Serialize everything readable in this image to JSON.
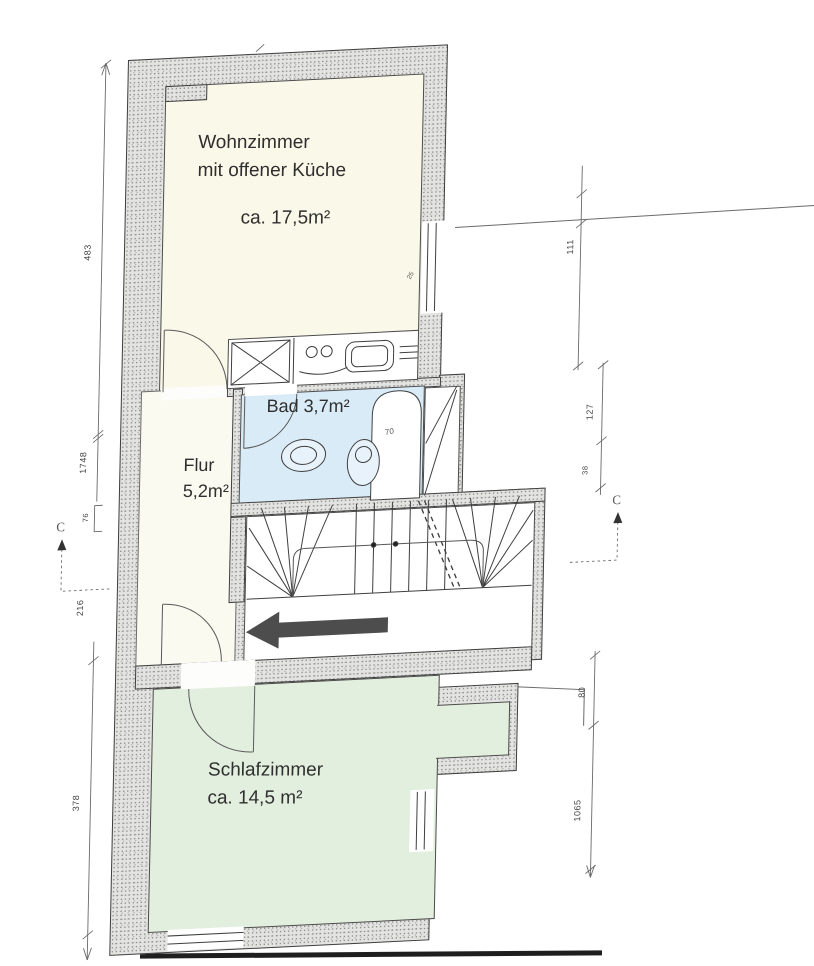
{
  "rooms": {
    "wohnzimmer": {
      "line1": "Wohnzimmer",
      "line2": "mit offener Küche",
      "area": "ca. 17,5m²"
    },
    "bad": {
      "label": "Bad 3,7m²"
    },
    "flur": {
      "name": "Flur",
      "area": "5,2m²"
    },
    "schlafzimmer": {
      "name": "Schlafzimmer",
      "area": "ca. 14,5 m²"
    }
  },
  "dimensions": {
    "left_top": "483",
    "left_mid": "1748",
    "left_small": "76",
    "left_center": "216",
    "left_bottom": "378",
    "right_top": "111",
    "right_mid": "127",
    "right_small": "38",
    "right_lower": "80",
    "right_bottom": "1065",
    "bathtub": "70",
    "window": "25"
  },
  "section_markers": {
    "left": "C",
    "right": "C"
  },
  "colors": {
    "wohnzimmer": "#faf8e8",
    "bad": "#d9ebf7",
    "schlafzimmer": "#e3efde",
    "flur": "#fbfaf1",
    "wall": "#e3e3e1",
    "arrow": "#4d4d4d"
  }
}
